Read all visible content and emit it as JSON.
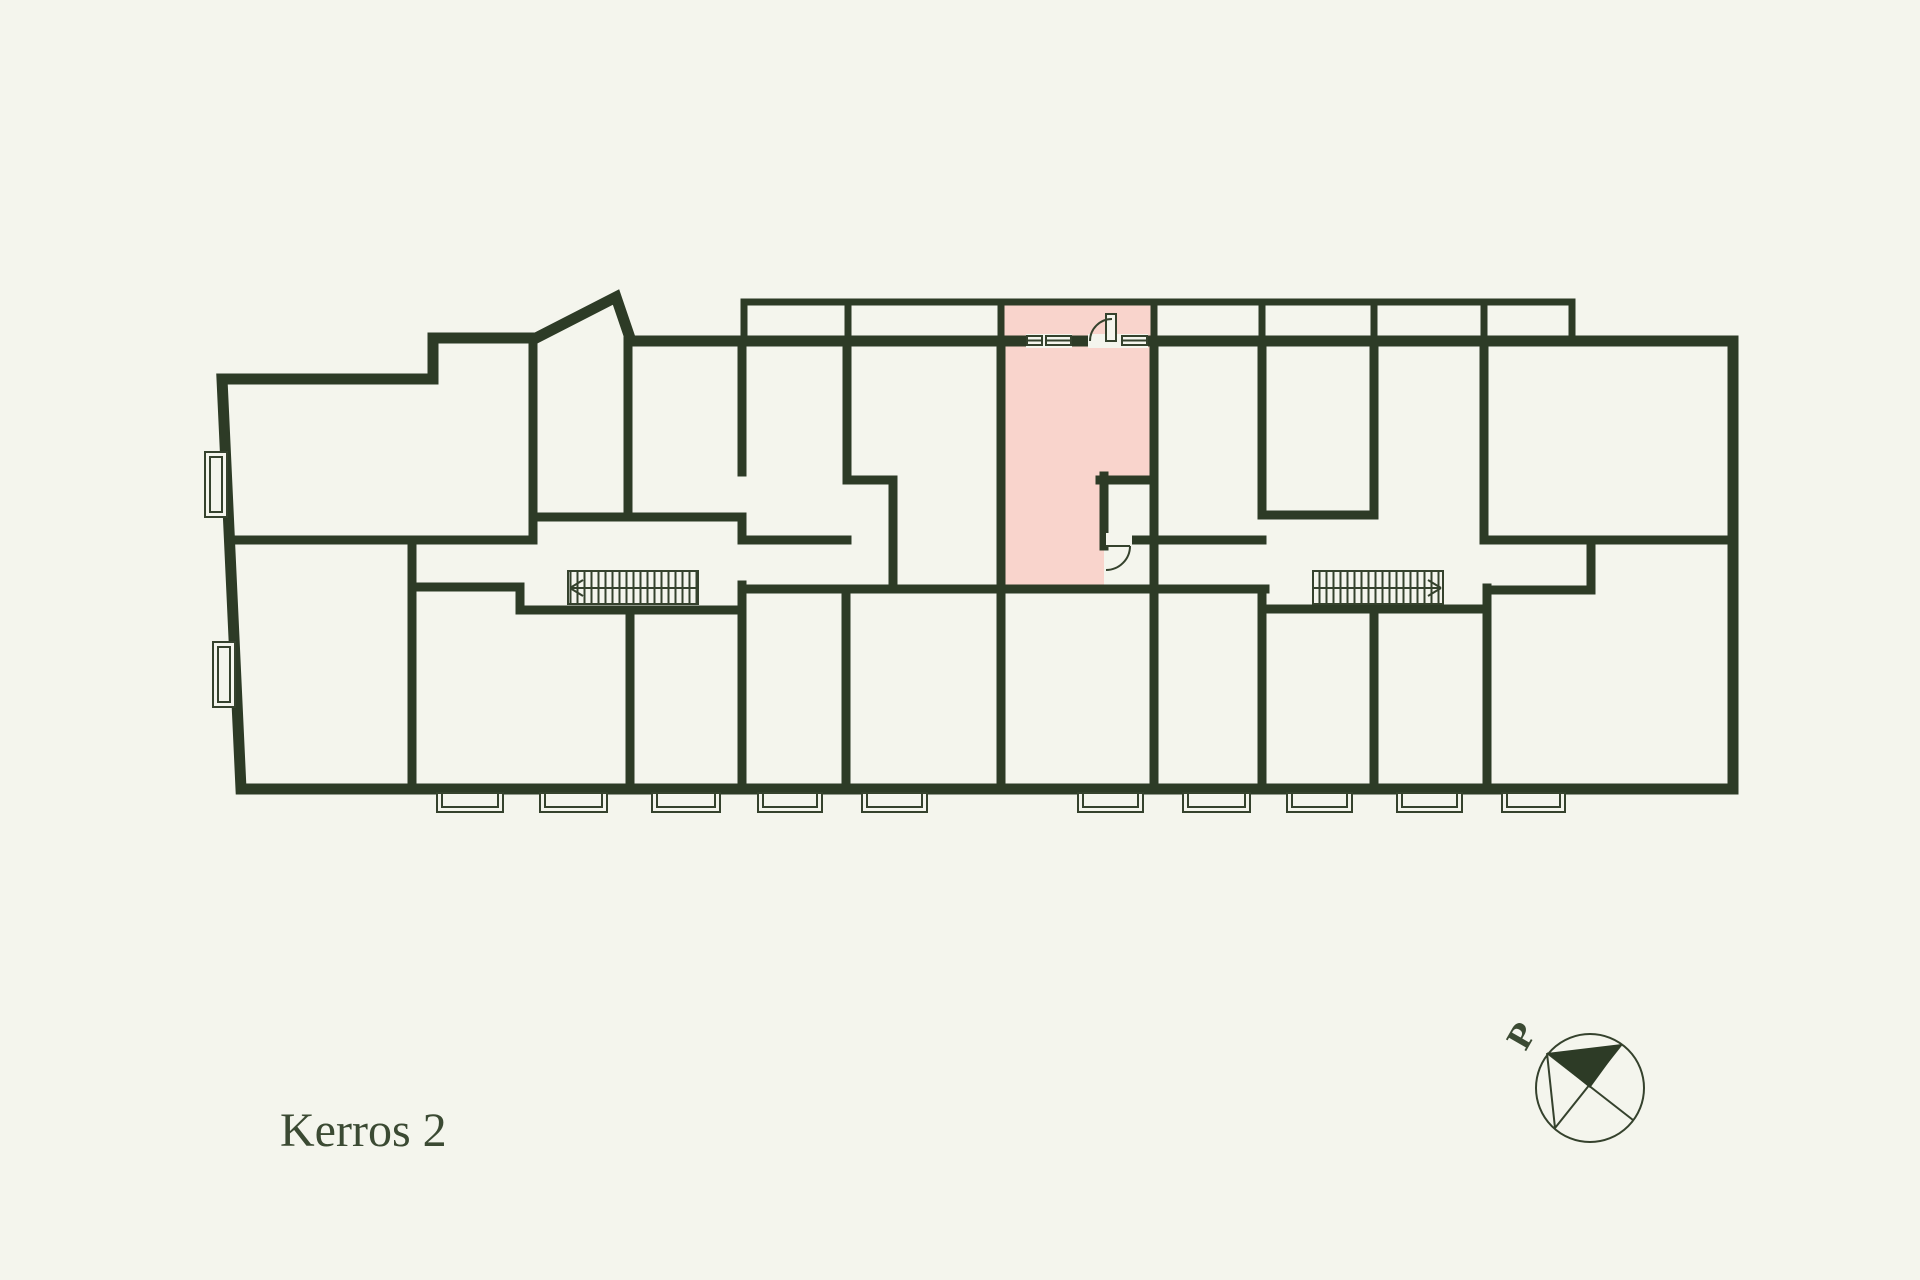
{
  "title": {
    "floor_label": "Kerros 2"
  },
  "compass": {
    "north_label": "P"
  },
  "colors": {
    "background": "#f4f5ed",
    "wall": "#2d3b26",
    "line": "#35422d",
    "highlight": "#f9d4cc",
    "text": "#3b4a33"
  }
}
